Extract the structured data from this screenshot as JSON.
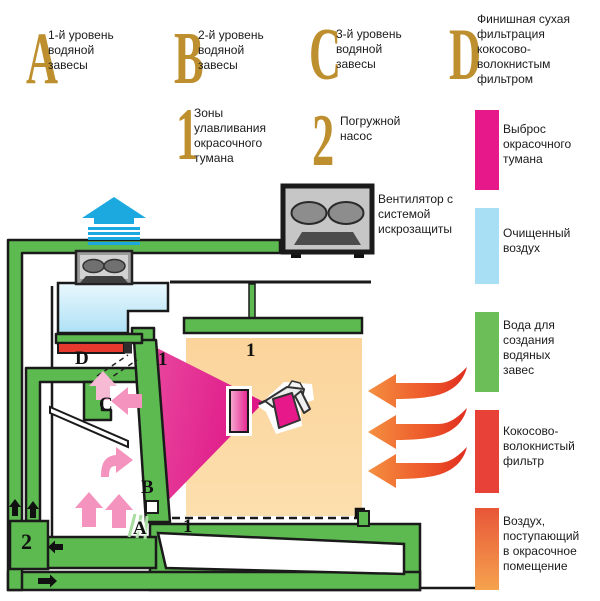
{
  "top_legend": {
    "marker_color": "#BE8F2E",
    "items": [
      {
        "marker": "A",
        "label": "1-й уровень\nводяной\nзавесы"
      },
      {
        "marker": "B",
        "label": "2-й уровень\nводяной\nзавесы"
      },
      {
        "marker": "C",
        "label": "3-й уровень\nводяной\nзавесы"
      },
      {
        "marker": "D",
        "label": "Финишная сухая\nфильтрация\nкокосово-\nволокнистым\nфильтром"
      },
      {
        "marker": "1",
        "label": "Зоны\nулавливания\nокрасочного\nтумана"
      },
      {
        "marker": "2",
        "label": "Погружной\nнасос"
      }
    ]
  },
  "fan_legend": {
    "label": "Вентилятор с\nсистемой\nискрозащиты"
  },
  "color_legend": {
    "items": [
      {
        "color": "#E7188A",
        "label": "Выброс\nокрасочного\nтумана"
      },
      {
        "color": "#A9DFF5",
        "label": "Очищенный\nвоздух"
      },
      {
        "color": "#6CBE58",
        "label": "Вода для\nсоздания\nводяных\nзавес"
      },
      {
        "color": "#E84238",
        "label": "Кокосово-\nволокнистый\nфильтр"
      },
      {
        "color_top": "#E85638",
        "color_bottom": "#F5A34E",
        "label": "Воздух,\nпоступающий\nв окрасочное\nпомещение"
      }
    ]
  },
  "diagram": {
    "labels": {
      "level_a": "A",
      "level_b": "B",
      "level_c": "C",
      "level_d": "D",
      "zone_1_top": "1",
      "zone_1_room": "1",
      "zone_1_floor": "1",
      "pump": "2"
    },
    "colors": {
      "pipe_green": "#5CBA50",
      "clean_air_blue": "#AEE1F5",
      "mist_magenta": "#DE1487",
      "filter_red": "#E8392F",
      "room_orange": "#FBD49B",
      "exhaust_blue": "#1CA9E0",
      "mist_pink_arrow": "#F493BE"
    }
  }
}
